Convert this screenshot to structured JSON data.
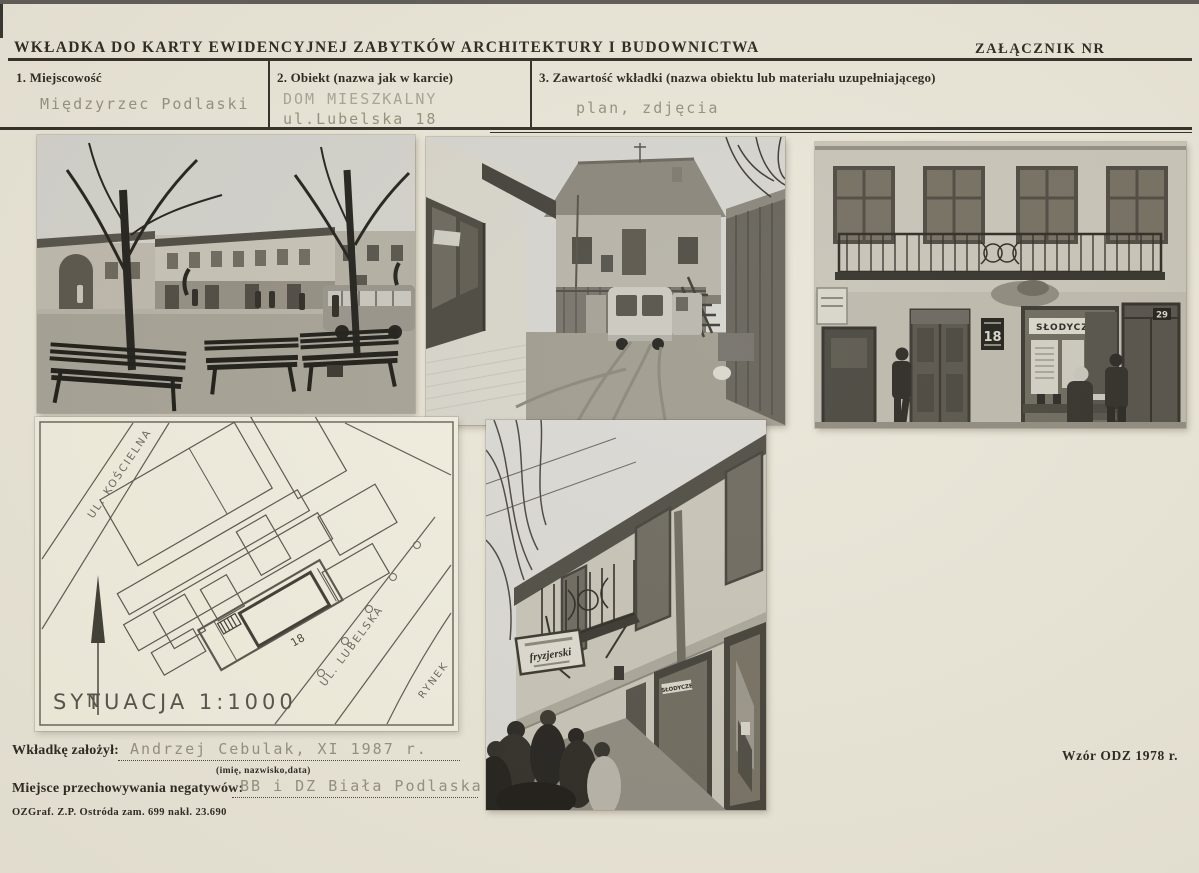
{
  "header": {
    "title": "WKŁADKA DO KARTY EWIDENCYJNEJ ZABYTKÓW ARCHITEKTURY I BUDOWNICTWA",
    "attachment_label": "ZAŁĄCZNIK NR"
  },
  "fields": {
    "locality": {
      "label": "1. Miejscowość",
      "value": "Międzyrzec Podlaski"
    },
    "object": {
      "label": "2. Obiekt (nazwa jak w karcie)",
      "value_line1": "DOM MIESZKALNY",
      "value_line2": "ul.Lubelska 18"
    },
    "contents": {
      "label": "3. Zawartość wkładki (nazwa obiektu lub materiału uzupełniającego)",
      "value": "plan, zdjęcia"
    }
  },
  "map": {
    "scale_label": "SYTUACJA 1:1000",
    "street_koscielna": "UL. KOŚCIELNA",
    "street_lubelska": "UL. LUBELSKA",
    "square_label": "RYNEK",
    "building_number": "18",
    "north_label": "N"
  },
  "photo_signs": {
    "facade_house_number": "18",
    "facade_shop_sign": "SŁODYCZE",
    "facade_door_number": "29",
    "oblique_barber_sign": "fryzjerski",
    "oblique_window_sign": "SŁODYCZE"
  },
  "footer": {
    "created_by_label": "Wkładkę założył:",
    "created_by_value": "Andrzej Cebulak, XI 1987 r.",
    "created_by_hint": "(imię, nazwisko,data)",
    "negatives_label": "Miejsce przechowywania negatywów:",
    "negatives_value": "BB i DZ Biała Podlaska",
    "print_info": "OZGraf. Z.P. Ostróda zam. 699 nakł. 23.690",
    "form_code": "Wzór ODZ 1978 r."
  },
  "colors": {
    "paper": "#e9e5d7",
    "ink": "#2b2820",
    "typewriter": "#94907e"
  }
}
